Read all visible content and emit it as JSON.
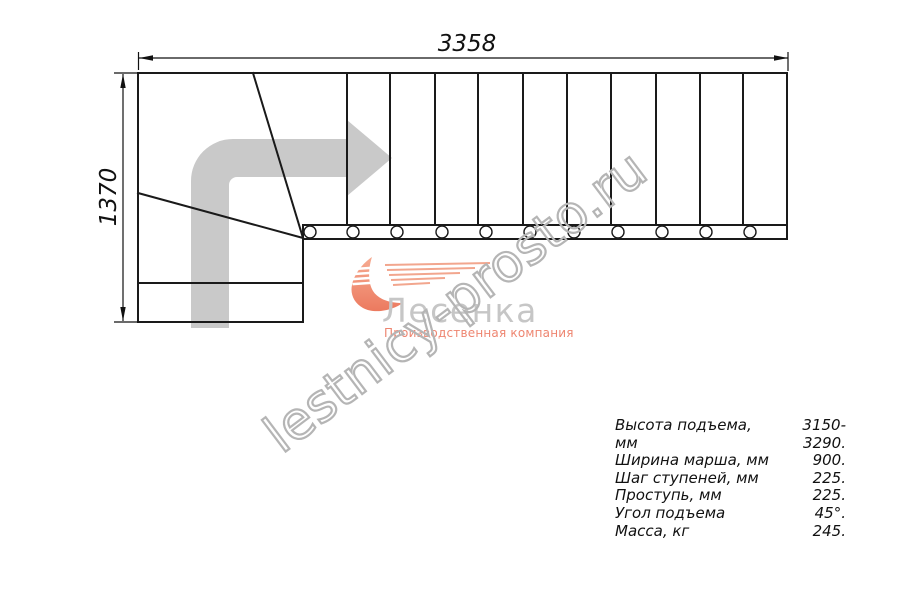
{
  "drawing": {
    "total_length_mm": "3358",
    "total_width_mm": "1370"
  },
  "watermark": {
    "text": "lestnicy-prosto.ru"
  },
  "logo": {
    "brand": "Лесенка",
    "tagline": "Производственная компания"
  },
  "specs": {
    "rows": [
      {
        "label": "Высота подъема, мм",
        "value": "3150-3290."
      },
      {
        "label": "Ширина марша, мм",
        "value": "900."
      },
      {
        "label": "Шаг ступеней, мм",
        "value": "225."
      },
      {
        "label": "Проступь, мм",
        "value": "225."
      },
      {
        "label": "Угол подъема",
        "value": "45°."
      },
      {
        "label": "Масса, кг",
        "value": "245."
      }
    ]
  },
  "colors": {
    "line": "#1a1a1a",
    "arrow_gray": "#c9c9c9",
    "brand_salmon": "#f19a82",
    "brand_text_gray": "#c6c6c6",
    "tagline_salmon": "#ee8570",
    "watermark_gray": "#b5b5b5"
  }
}
